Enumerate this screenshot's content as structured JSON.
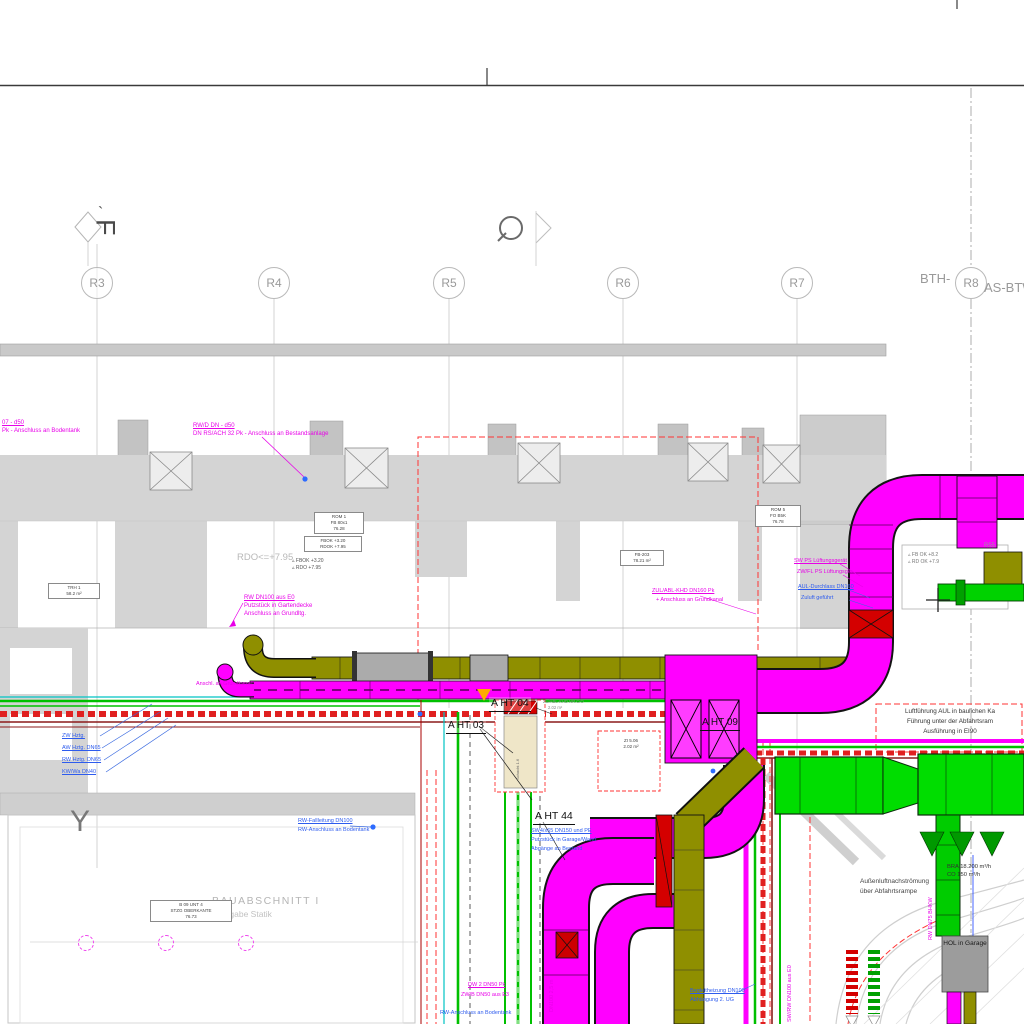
{
  "grid": {
    "prefix": "BTH-",
    "suffix": "AS-BTW",
    "columns": [
      {
        "label": "R3"
      },
      {
        "label": "R4"
      },
      {
        "label": "R5"
      },
      {
        "label": "R6"
      },
      {
        "label": "R7"
      },
      {
        "label": "R8"
      }
    ]
  },
  "markers": {
    "section_letter": "F",
    "accent": "`",
    "axis_letter": "Y"
  },
  "icons": {
    "level_triangle": "▵"
  },
  "ht": {
    "ht04": "A HT 04",
    "ht03": "A HT 03",
    "ht44": "A HT 44",
    "ht09": "A HT 09"
  },
  "levels": {
    "band": "RDO<=+7.95",
    "fbok": "FBOK +3.20",
    "rdo": "RDO +7.95",
    "fbok_r": "FB OK +8.2",
    "rdo_r": "RD OK +7.9",
    "r55": "R55"
  },
  "notes": {
    "duct1": "Luftführung AUL in baulichen Ka",
    "duct2": "Führung unter der Abfahrtsram",
    "duct3": "Ausführung in EI90",
    "out1": "Außenluftnachströmung",
    "out2": "über Abfahrtsrampe",
    "bra": "BRA 18.200 m³/h",
    "co": "CO 150 m³/h",
    "hol": "HOL in Garage",
    "bau1": "BAUABSCHNITT I",
    "bau2": "Angabe Statik"
  },
  "pipes": {
    "p1": "ZW Hztg.",
    "p2": "AW Hztg. DN65",
    "p3": "RW Hztg. DN65",
    "p4": "KW/Wa DN40"
  },
  "magenta": {
    "top1": "RW/D DN - d50",
    "top2": "DN RS/ACH 32 Pk - Anschluss an Bestandsanlage",
    "corner1": "07 - d50",
    "corner2": "Pk - Anschluss an Bodentank",
    "mid1": "RW DN100 aus E0",
    "mid2": "Putzstück in Gartendecke",
    "mid3": "Anschluss an Grundltg.",
    "grund": "Anschl. an Grundkanal",
    "swps1": "SW PS Lüftungsgerät",
    "swps2": "ZW/FL PS Lüftungsger.",
    "zul1": "ZUL/ABL-KHD DN160 Pk",
    "zul2": "+ Anschluss an Grundkanal",
    "dn1": "DW 2 DN50 Pk",
    "dn2": "ZW/B DN50 aus E3",
    "dnv": "DN100 2,5 m",
    "swrw": "SW/RW DN100 aus E0",
    "bhkw": "RW DN75 BHKW"
  },
  "blue": {
    "aul1": "AUL-Durchlass DN160",
    "aul2": "Zuluft geführt",
    "sw41": "SW4/x65 DN150 und PE",
    "sw42": "Putzstück in Garage/Wand",
    "sw43": "Abgänge an Bestand",
    "fall1": "RW-Fallleitung DN100",
    "fall2": "RW-Anschluss an Bodentank",
    "beg1": "Begleitheizung DN100",
    "beg2": "Abhängung 2. UG",
    "bod": "RW-Anschluss an Bodentank"
  },
  "stamps": {
    "s1a": "ROM 1",
    "s1b": "FB 80x1",
    "s1c": "76.28",
    "s2a": "FB-203",
    "s2b": "78.21 m²",
    "s3a": "ROM 5",
    "s3b": "FO B5K",
    "s3c": "76.78",
    "s4a": "FBOK +3.20",
    "s4b": "RDOK +7.95",
    "s5a": "TRH 1",
    "s5b": "58.2 m²",
    "s6a": "ZI 5.06",
    "s6b": "2.02 m²",
    "s7a": "B 09 UNT 4",
    "s7b": "STZG OBERKANTE",
    "s7c": "76.73",
    "shaft": "Schacht 1.6",
    "zu1": "ZU/ABL-KHD NR.C/O",
    "zu2": "2.02 m²"
  }
}
